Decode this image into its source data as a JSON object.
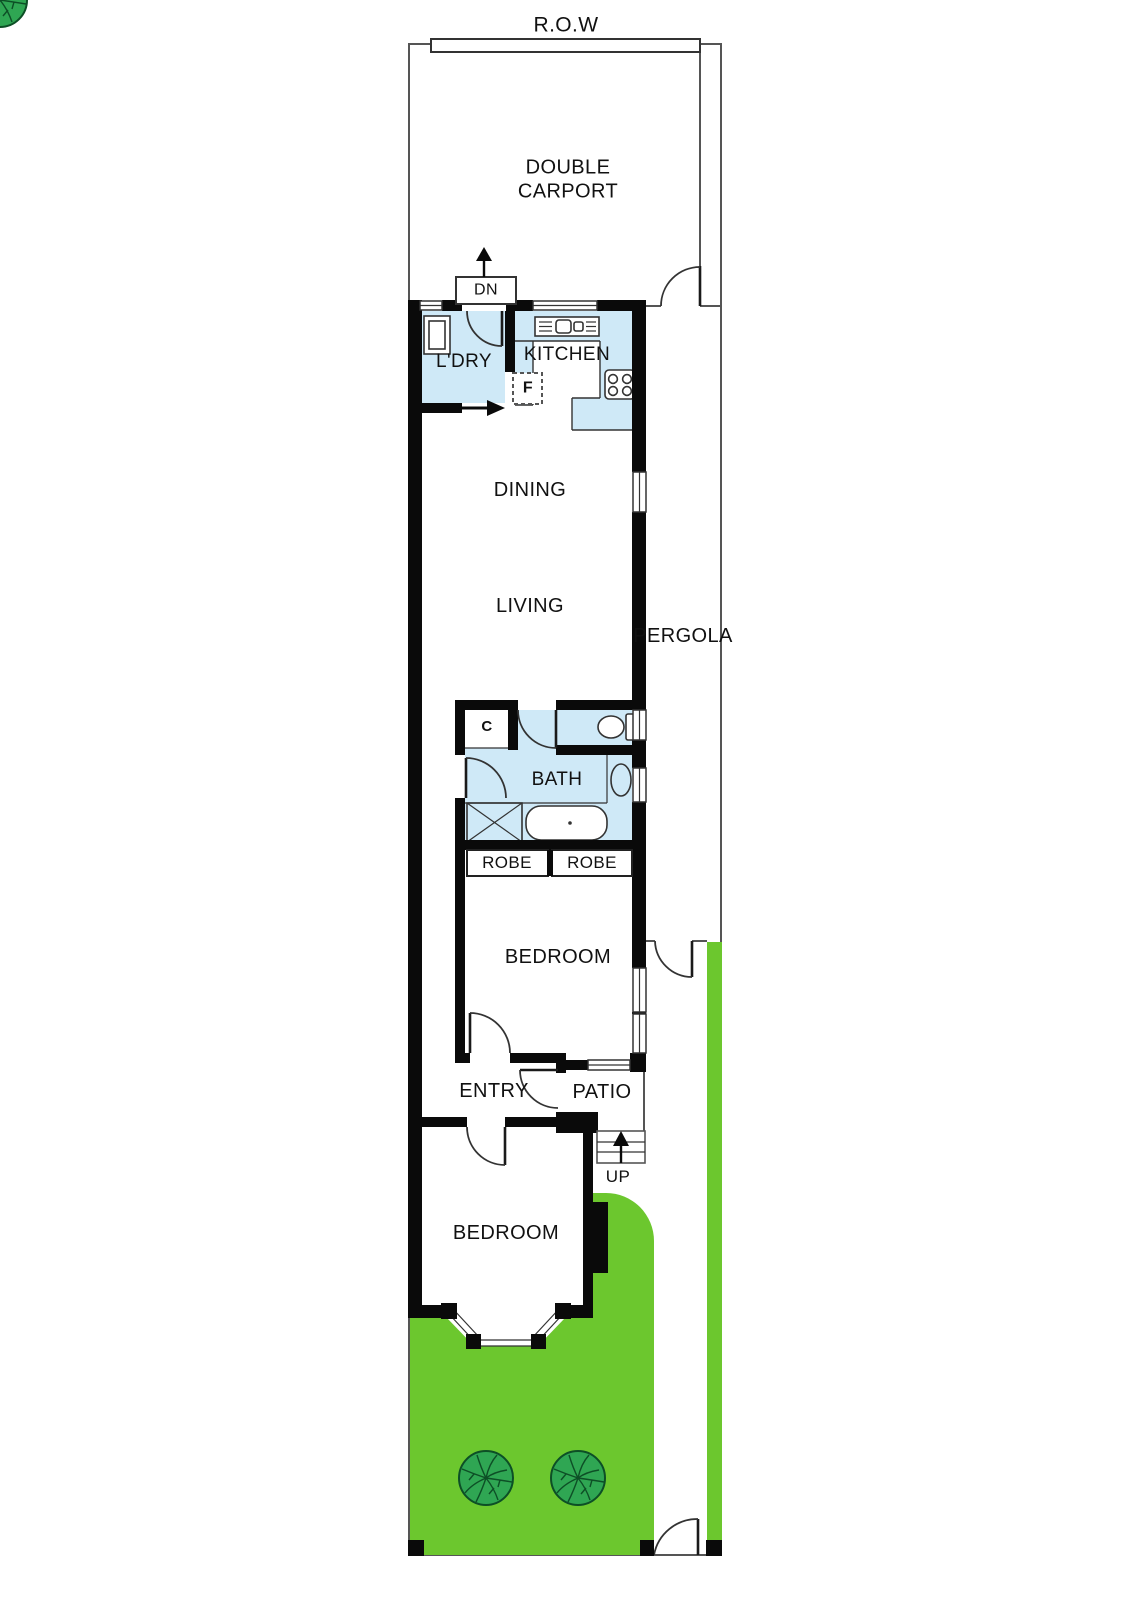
{
  "plan": {
    "title": "R.O.W",
    "labels": {
      "row": "R.O.W",
      "carport_line1": "DOUBLE",
      "carport_line2": "CARPORT",
      "dn": "DN",
      "laundry": "L'DRY",
      "kitchen": "KITCHEN",
      "fridge": "F",
      "dining": "DINING",
      "living": "LIVING",
      "pergola": "PERGOLA",
      "closet": "C",
      "bath": "BATH",
      "robe_left": "ROBE",
      "robe_right": "ROBE",
      "bedroom_rear": "BEDROOM",
      "entry": "ENTRY",
      "patio": "PATIO",
      "up": "UP",
      "bedroom_front": "BEDROOM"
    }
  },
  "colors": {
    "background": "#ffffff",
    "wall": "#0a0a0a",
    "wet_area": "#cfe9f7",
    "garden": "#6cc72e",
    "tree": "#2fa653",
    "tree_line": "#0d4f26",
    "boundary_line": "#555555",
    "fixture_line": "#333333",
    "text": "#111111"
  }
}
